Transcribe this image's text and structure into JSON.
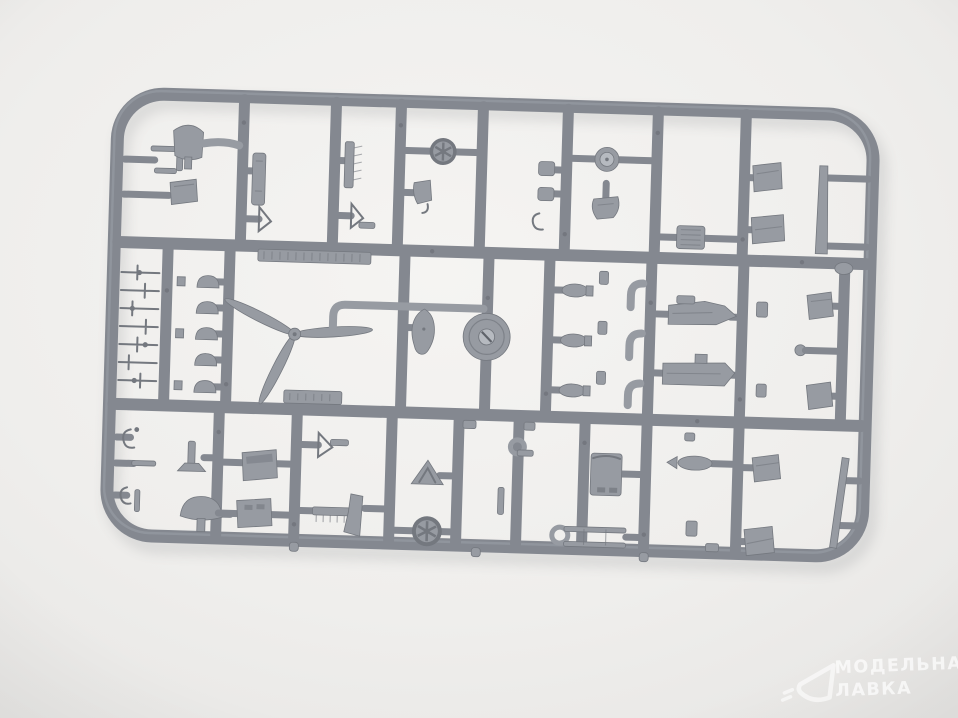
{
  "scene": {
    "type": "product photograph",
    "subject": "grey injection-molded plastic model kit sprue (parts runner frame) lying on a light neutral studio background",
    "details": "rectangular runner frame with rounded corners, two internal horizontal runners and many vertical runners holding ~50 small aircraft-model parts, including two embossed illegible label plates"
  },
  "watermark": {
    "line1": "МОДЕЛЬНАЯ",
    "line2": "ЛАВКА",
    "logo": "paper-plane-triangle"
  },
  "colors": {
    "bg_center": "#f5f4f2",
    "bg_edge": "#e7e6e4",
    "sprue": "#848890",
    "sprue_light": "#9ba0a7",
    "sprue_dark": "#6d7178",
    "part": "#979ba2",
    "part_dark": "#74787f",
    "hub": "#b6bac0",
    "watermark": "#ffffff"
  },
  "parts": [
    "propeller-3-blade",
    "spinner-teardrop",
    "main-wheel-disc",
    "spoked-wheel-top",
    "spoked-wheel-bottom",
    "fuselage-half-upper",
    "fuselage-half-lower",
    "engine-block",
    "instrument-panel-upper",
    "instrument-panel-lower",
    "seat-box-upper",
    "seat-box-lower",
    "drum-cylinder",
    "torpedo-bomb",
    "exhaust-elbow-set",
    "small-lever-ladder-set",
    "dome-cap-set",
    "shovel-blade",
    "mushroom-tailwheel",
    "canopy-windscreen",
    "ladder-frame",
    "long-strut-bar",
    "tapered-blade-strut",
    "embossed-label-plate-large",
    "embossed-label-plate-small",
    "angled-panel-set",
    "hook-set",
    "comb-strip-set"
  ]
}
